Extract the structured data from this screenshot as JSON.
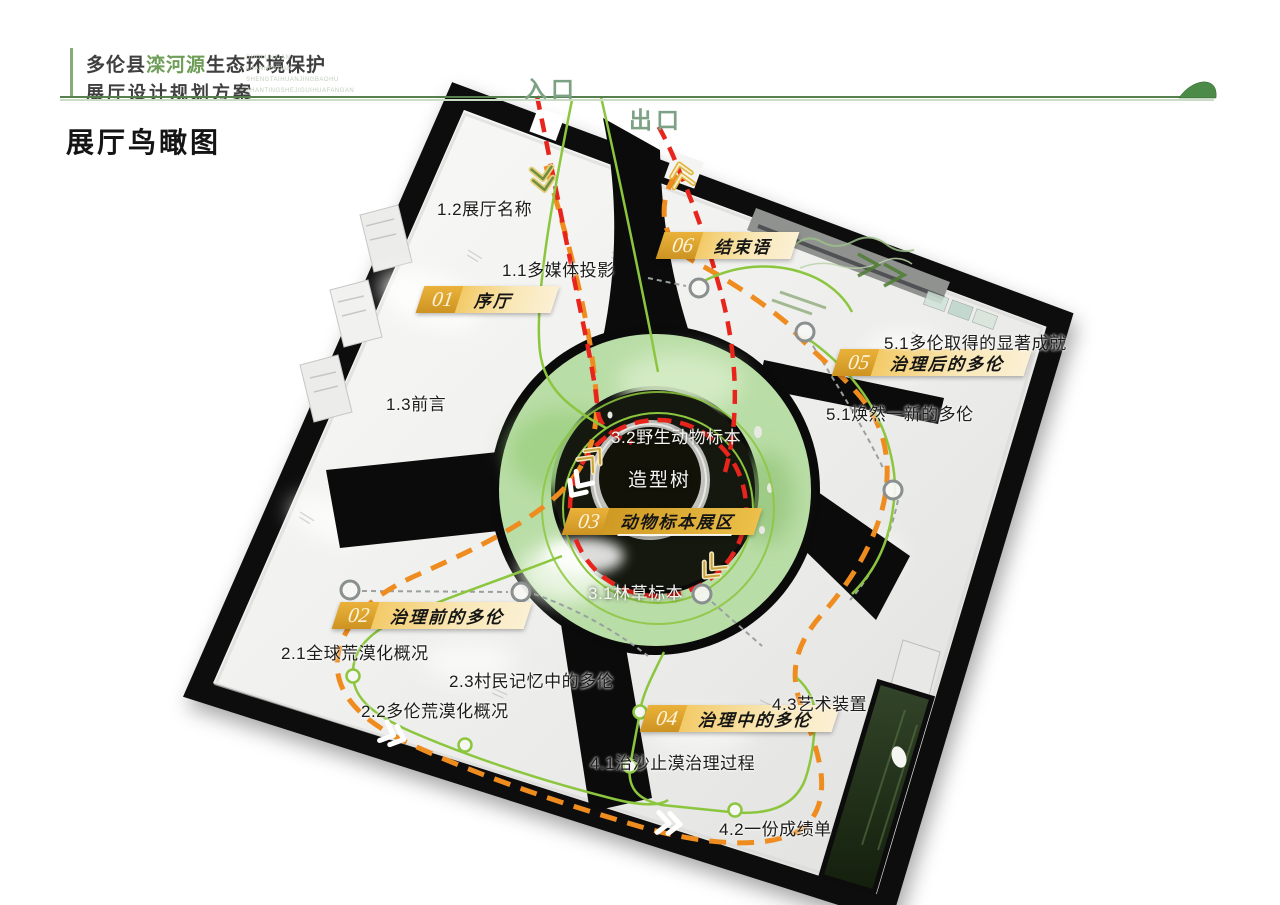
{
  "header": {
    "title_cn_1a": "多伦县",
    "title_cn_1b": "滦河源",
    "title_cn_1c": "生态环境保护",
    "title_cn_2": "展厅设计规划方案",
    "pinyin": [
      "DUOLUNXIAN",
      "LUANHEYUAN",
      "SHENGTAIHUANJINGBAOHU",
      "ZHANTINGSHEJIGUIHUAFANGAN"
    ]
  },
  "page_title": "展厅鸟瞰图",
  "plan": {
    "entrance_label": "入口",
    "exit_label": "出口",
    "zones": [
      {
        "num": "01",
        "label": "序厅"
      },
      {
        "num": "02",
        "label": "治理前的多伦"
      },
      {
        "num": "03",
        "label": "动物标本展区"
      },
      {
        "num": "04",
        "label": "治理中的多伦"
      },
      {
        "num": "05",
        "label": "治理后的多伦"
      },
      {
        "num": "06",
        "label": "结束语"
      }
    ],
    "labels": [
      "1.2展厅名称",
      "1.1多媒体投影",
      "1.3前言",
      "2.1全球荒漠化概况",
      "2.3村民记忆中的多伦",
      "2.2多伦荒漠化概况",
      "3.2野生动物标本",
      "造型树",
      "3.1林草标本",
      "4.3艺术装置",
      "4.1治沙止漠治理过程",
      "4.2一份成绩单",
      "5.1多伦取得的显著成就",
      "5.1焕然一新的多伦"
    ]
  },
  "colors": {
    "header_green": "#6f9e58",
    "gate_green": "#7da184",
    "route_red": "#e8251d",
    "route_orange": "#ef8c1f",
    "route_green": "#8cc63e",
    "banner_gold": "#d99b26",
    "banner_band": "#f7dd9a"
  },
  "icons": {
    "leaf": "leaf-icon",
    "route_arrow": "chevron-arrow-icon",
    "route_node": "route-node-icon"
  }
}
